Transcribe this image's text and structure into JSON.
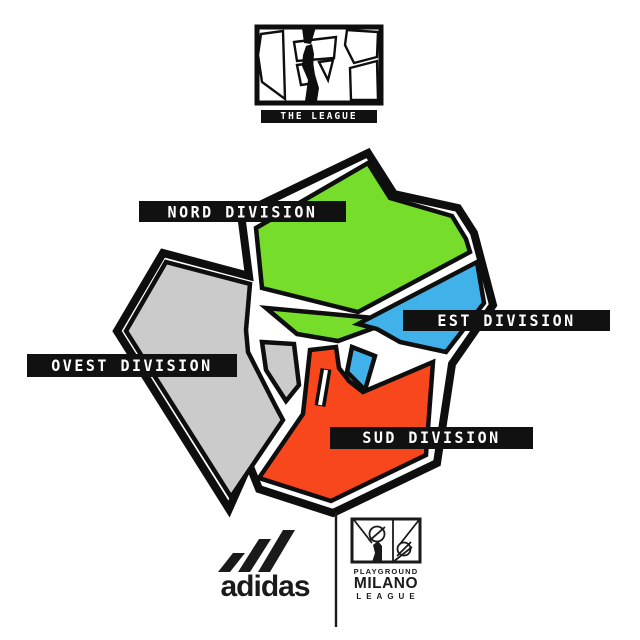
{
  "page": {
    "background": "#FFFFFF"
  },
  "league_logo": {
    "title": "THE LEAGUE"
  },
  "map": {
    "label_bar_bg": "#111111",
    "label_text_color": "#FFFFFF",
    "divisions": [
      {
        "id": "nord",
        "label": "NORD DIVISION",
        "color": "#77DD2B"
      },
      {
        "id": "est",
        "label": "EST DIVISION",
        "color": "#41B2E9"
      },
      {
        "id": "ovest",
        "label": "OVEST DIVISION",
        "color": "#CBCBCB"
      },
      {
        "id": "sud",
        "label": "SUD DIVISION",
        "color": "#F8471C"
      }
    ]
  },
  "footer": {
    "adidas_wordmark": "adidas",
    "playground": {
      "line1": "PLAYGROUND",
      "line2": "MILANO",
      "line3": "LEAGUE"
    }
  },
  "artwork": {
    "ink": "#0E0E0E",
    "shapes": [
      {
        "name": "map-outer-border",
        "kind": "polygon",
        "fill": "none",
        "stroke": "#0E0E0E",
        "sw": 8,
        "pts": "368,153 394,194 458,208 474,233 493,305 452,364 437,463 333,513 259,489 249,464 229,509 117,331 163,253 249,276 241,214"
      },
      {
        "name": "region-nord-main",
        "kind": "polygon",
        "fill": "#77DD2B",
        "stroke": "#0E0E0E",
        "sw": 4.5,
        "pts": "368,163 390,198 452,216 466,239 470,252 358,312 262,288 256,228"
      },
      {
        "name": "region-nord-strip",
        "kind": "polygon",
        "fill": "#77DD2B",
        "stroke": "#0E0E0E",
        "sw": 4.5,
        "pts": "266,308 396,320 338,341 297,334"
      },
      {
        "name": "region-est-main",
        "kind": "polygon",
        "fill": "#41B2E9",
        "stroke": "#0E0E0E",
        "sw": 4.5,
        "pts": "477,262 484,303 446,352 400,342 377,329 358,324"
      },
      {
        "name": "region-est-wedge",
        "kind": "polygon",
        "fill": "#41B2E9",
        "stroke": "#0E0E0E",
        "sw": 4.5,
        "pts": "352,347 375,356 365,390 347,372"
      },
      {
        "name": "region-ovest-main",
        "kind": "polygon",
        "fill": "#CBCBCB",
        "stroke": "#0E0E0E",
        "sw": 4.5,
        "pts": "166,262 250,284 246,330 248,352 276,407 283,420 231,497 126,331"
      },
      {
        "name": "region-ovest-wedge",
        "kind": "polygon",
        "fill": "#CBCBCB",
        "stroke": "#0E0E0E",
        "sw": 4.5,
        "pts": "262,342 294,344 299,385 286,401 266,370"
      },
      {
        "name": "region-sud-main",
        "kind": "polygon",
        "fill": "#F8471C",
        "stroke": "#0E0E0E",
        "sw": 4.5,
        "pts": "310,350 336,347 339,368 349,381 363,392 433,362 426,455 331,501 259,478 303,414"
      },
      {
        "name": "sud-notch-road-black",
        "kind": "polyline",
        "fill": "none",
        "stroke": "#0E0E0E",
        "sw": 11,
        "pts": "320,406 326,369"
      },
      {
        "name": "sud-notch-road-white",
        "kind": "polyline",
        "fill": "none",
        "stroke": "#FFFFFF",
        "sw": 4,
        "pts": "320,405 326,370"
      },
      {
        "name": "league-logo-box",
        "kind": "polygon",
        "fill": "#FFFFFF",
        "stroke": "#0E0E0E",
        "sw": 5,
        "pts": "257,27 381,27 381,103 257,103"
      },
      {
        "name": "league-mini-left",
        "kind": "polygon",
        "fill": "#FFFFFF",
        "stroke": "#0E0E0E",
        "sw": 2.4,
        "pts": "261,34 283,31 285,99 262,82 258,55"
      },
      {
        "name": "league-mini-center-top",
        "kind": "polygon",
        "fill": "#FFFFFF",
        "stroke": "#0E0E0E",
        "sw": 2.4,
        "pts": "294,42 336,37 334,58 297,61"
      },
      {
        "name": "league-mini-center-left",
        "kind": "polygon",
        "fill": "#FFFFFF",
        "stroke": "#0E0E0E",
        "sw": 2.4,
        "pts": "297,65 312,63 315,83 301,85"
      },
      {
        "name": "league-mini-center-right",
        "kind": "polygon",
        "fill": "#FFFFFF",
        "stroke": "#0E0E0E",
        "sw": 2.4,
        "pts": "319,62 333,60 328,80"
      },
      {
        "name": "league-mini-right-top",
        "kind": "polygon",
        "fill": "#FFFFFF",
        "stroke": "#0E0E0E",
        "sw": 2.4,
        "pts": "347,30 378,32 377,57 354,63 345,45"
      },
      {
        "name": "league-mini-right-bottom",
        "kind": "polygon",
        "fill": "#FFFFFF",
        "stroke": "#0E0E0E",
        "sw": 2.4,
        "pts": "350,68 377,61 378,100 351,100"
      },
      {
        "name": "league-mini-apex-mark",
        "kind": "polygon",
        "fill": "#0E0E0E",
        "stroke": "none",
        "sw": 0,
        "pts": "302,28 316,27 311,44 304,43"
      },
      {
        "name": "league-mini-player-figure",
        "kind": "polygon",
        "fill": "#0E0E0E",
        "stroke": "none",
        "sw": 0,
        "pts": "303,55 306,46 312,44 314,54 313,68 319,88 317,101 305,101 308,80 302,66"
      },
      {
        "name": "adidas-stripe-1",
        "kind": "polygon",
        "fill": "#1A1A1A",
        "stroke": "none",
        "sw": 0,
        "pts": "218,572 233,553 245,553 230,572"
      },
      {
        "name": "adidas-stripe-2",
        "kind": "polygon",
        "fill": "#1A1A1A",
        "stroke": "none",
        "sw": 0,
        "pts": "238,572 259,539 271,539 250,572"
      },
      {
        "name": "adidas-stripe-3",
        "kind": "polygon",
        "fill": "#1A1A1A",
        "stroke": "none",
        "sw": 0,
        "pts": "258,572 283,530 295,530 270,572"
      },
      {
        "name": "footer-divider-line",
        "kind": "polyline",
        "fill": "none",
        "stroke": "#1A1A1A",
        "sw": 2.4,
        "pts": "336,512 336,627"
      },
      {
        "name": "playground-logo-box",
        "kind": "polygon",
        "fill": "#FFFFFF",
        "stroke": "#1A1A1A",
        "sw": 3,
        "pts": "352,519 420,519 420,562 352,562"
      },
      {
        "name": "playground-court-divider",
        "kind": "polyline",
        "fill": "none",
        "stroke": "#1A1A1A",
        "sw": 1.8,
        "pts": "393,519 393,562"
      },
      {
        "name": "playground-ball-circle-1",
        "kind": "circle",
        "fill": "none",
        "stroke": "#1A1A1A",
        "sw": 1.8,
        "cx": 377,
        "cy": 534,
        "r": 7.5
      },
      {
        "name": "playground-ball-slash-1",
        "kind": "polyline",
        "fill": "none",
        "stroke": "#1A1A1A",
        "sw": 1.8,
        "pts": "369,541 385,527"
      },
      {
        "name": "playground-ball-circle-2",
        "kind": "circle",
        "fill": "none",
        "stroke": "#1A1A1A",
        "sw": 1.8,
        "cx": 404,
        "cy": 549,
        "r": 6.5
      },
      {
        "name": "playground-ball-slash-2",
        "kind": "polyline",
        "fill": "none",
        "stroke": "#1A1A1A",
        "sw": 1.8,
        "pts": "397,556 411,542"
      },
      {
        "name": "playground-court-diag-1",
        "kind": "polyline",
        "fill": "none",
        "stroke": "#1A1A1A",
        "sw": 1.8,
        "pts": "354,520 372,543"
      },
      {
        "name": "playground-court-diag-2",
        "kind": "polyline",
        "fill": "none",
        "stroke": "#1A1A1A",
        "sw": 1.8,
        "pts": "419,520 400,544"
      },
      {
        "name": "playground-court-diag-3",
        "kind": "polyline",
        "fill": "none",
        "stroke": "#1A1A1A",
        "sw": 1.8,
        "pts": "393,562 412,547"
      },
      {
        "name": "playground-player-figure",
        "kind": "polygon",
        "fill": "#1A1A1A",
        "stroke": "none",
        "sw": 0,
        "pts": "373,545 378,541 382,546 382,562 372,562 375,553"
      }
    ]
  }
}
